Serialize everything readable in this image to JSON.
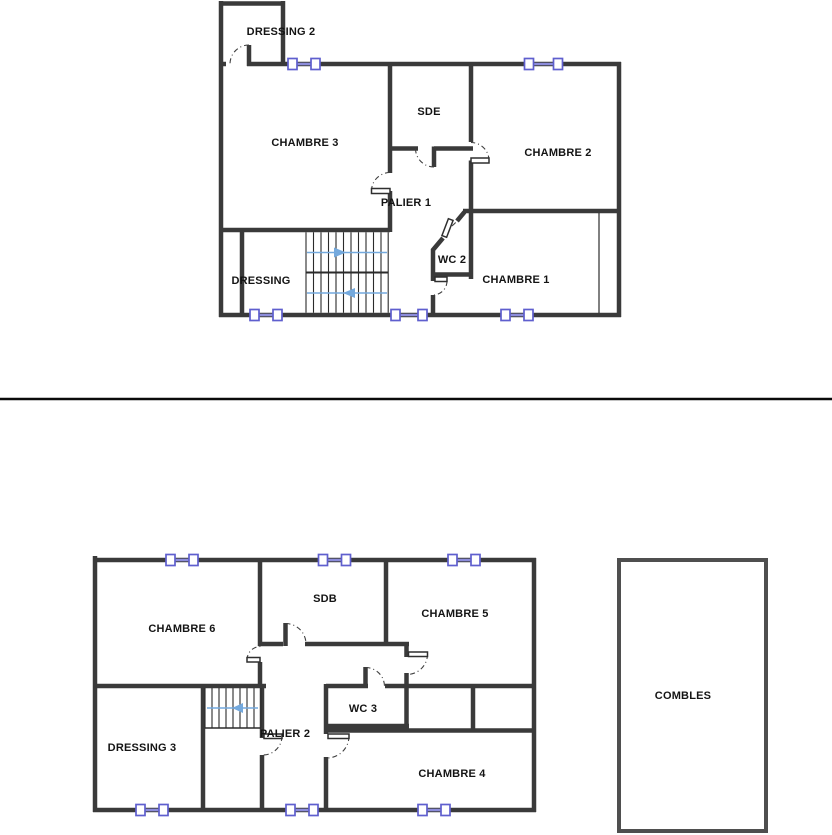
{
  "document": {
    "kind": "floor-plan-page",
    "background": "#ffffff",
    "divider_color": "#0a0a0a"
  },
  "colors": {
    "wall": "#3a3a3a",
    "thin_line": "#2d2d2d",
    "door_arc": "#3f3f3f",
    "door_leaf_fill": "#ffffff",
    "door_leaf_stroke": "#2f2f2f",
    "window_frame": "#5f5fce",
    "window_bar": "#8c8cdb",
    "stair_arrow": "#74a9dd",
    "label_text": "#141414"
  },
  "plans": [
    {
      "id": "upper-floor-plan",
      "rooms": [
        {
          "label": "DRESSING 2"
        },
        {
          "label": "CHAMBRE 3"
        },
        {
          "label": "SDE"
        },
        {
          "label": "CHAMBRE 2"
        },
        {
          "label": "PALIER 1"
        },
        {
          "label": "DRESSING"
        },
        {
          "label": "WC 2"
        },
        {
          "label": "CHAMBRE 1"
        }
      ],
      "window_count": 5,
      "stairs": {
        "flights": 2,
        "arrow_directions": [
          "right",
          "left"
        ]
      }
    },
    {
      "id": "lower-floor-plan",
      "rooms": [
        {
          "label": "CHAMBRE 6"
        },
        {
          "label": "SDB"
        },
        {
          "label": "CHAMBRE 5"
        },
        {
          "label": "DRESSING 3"
        },
        {
          "label": "PALIER 2"
        },
        {
          "label": "WC 3"
        },
        {
          "label": "CHAMBRE 4"
        }
      ],
      "window_count": 6,
      "stairs": {
        "flights": 1,
        "arrow_directions": [
          "left"
        ]
      }
    },
    {
      "id": "attic-plan",
      "rooms": [
        {
          "label": "COMBLES"
        }
      ],
      "window_count": 0
    }
  ]
}
